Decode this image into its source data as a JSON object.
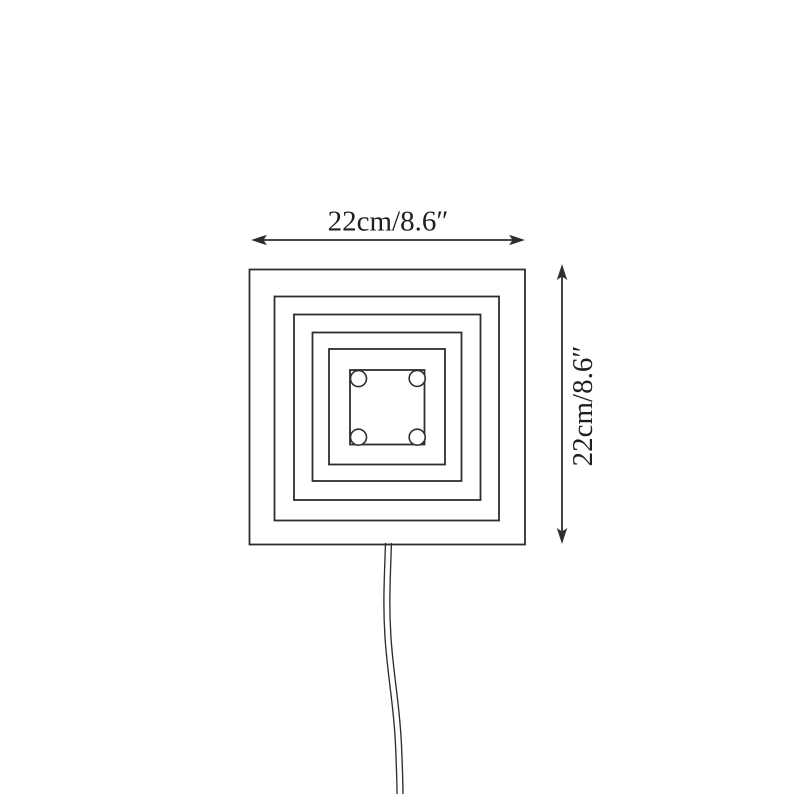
{
  "page": {
    "background_color": "#ffffff",
    "line_color": "#2e2e2e",
    "text_color": "#1f1f1f"
  },
  "diagram": {
    "kind": "product-dimension-line-drawing",
    "subject": "square-spiral-wall-lamp-front-view",
    "nested_frame_count": 6,
    "corner_screw_count": 4,
    "width_dimension": {
      "label": "22cm/8.6″"
    },
    "height_dimension": {
      "label": "22cm/8.6″"
    }
  }
}
